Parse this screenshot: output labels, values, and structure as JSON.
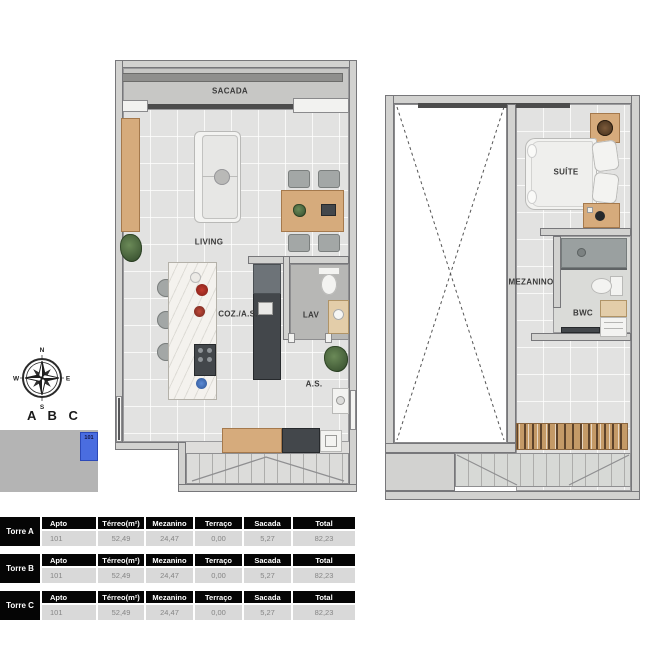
{
  "compass": {
    "north": "N",
    "east": "E",
    "south": "S",
    "west": "W"
  },
  "building_label": "A B C",
  "site_plan": {
    "unit_number": "101"
  },
  "ground_plan": {
    "labels": {
      "sacada": "SACADA",
      "living": "LIVING",
      "cozinha": "COZ./A.S.",
      "lavabo": "LAV",
      "area_servico": "A.S."
    }
  },
  "mezzanine_plan": {
    "labels": {
      "suite": "SUÍTE",
      "mezanino": "MEZANINO",
      "bwc": "BWC"
    }
  },
  "area_tables": [
    {
      "tower": "Torre A",
      "headers": [
        "Apto",
        "Térreo(m²)",
        "Mezanino",
        "Terraço",
        "Sacada",
        "Total"
      ],
      "row": [
        "101",
        "52,49",
        "24,47",
        "0,00",
        "5,27",
        "82,23"
      ]
    },
    {
      "tower": "Torre B",
      "headers": [
        "Apto",
        "Térreo(m²)",
        "Mezanino",
        "Terraço",
        "Sacada",
        "Total"
      ],
      "row": [
        "101",
        "52,49",
        "24,47",
        "0,00",
        "5,27",
        "82,23"
      ]
    },
    {
      "tower": "Torre C",
      "headers": [
        "Apto",
        "Térreo(m²)",
        "Mezanino",
        "Terraço",
        "Sacada",
        "Total"
      ],
      "row": [
        "101",
        "52,49",
        "24,47",
        "0,00",
        "5,27",
        "82,23"
      ]
    }
  ],
  "colors": {
    "accent_blue": "#4a6de0",
    "table_header_bg": "#050505",
    "wood": "#d6ab7c"
  }
}
